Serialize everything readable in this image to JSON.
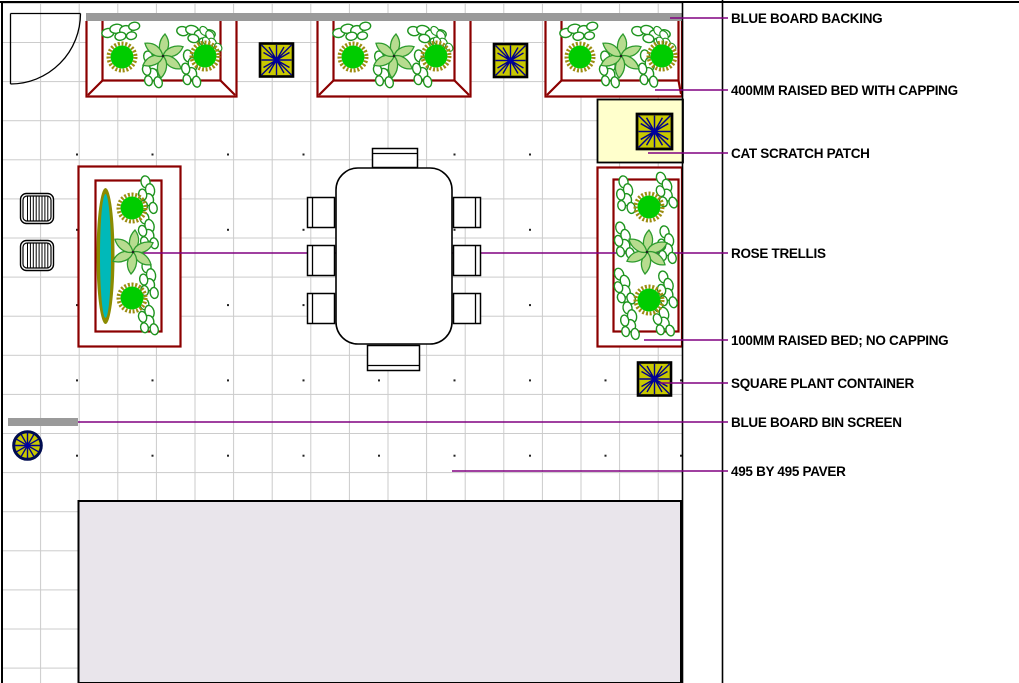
{
  "plan": {
    "legend_labels": [
      "BLUE BOARD BACKING",
      "400MM RAISED BED WITH CAPPING",
      "CAT SCRATCH PATCH",
      "ROSE TRELLIS",
      "100MM RAISED BED; NO CAPPING",
      "SQUARE PLANT CONTAINER",
      "BLUE BOARD BIN SCREEN",
      "495 BY 495 PAVER"
    ]
  },
  "colors": {
    "bed_border": "#8B0000",
    "backing_gray": "#9A9A9A",
    "container_yellow": "#C8C800",
    "starburst_navy": "#00008B",
    "patch_cream": "#FFFFCC",
    "plant_green": "#00CC00",
    "plant_ring_olive": "#9C8C10",
    "foliage_light_green": "#B7DC8F",
    "foliage_outline": "#2E9B2E",
    "trellis_teal": "#00B9B9",
    "trellis_olive": "#8B8B00",
    "leader_purple": "#800080",
    "grid_gray": "#CBCBCB",
    "building_fill": "#E9E5EB"
  }
}
